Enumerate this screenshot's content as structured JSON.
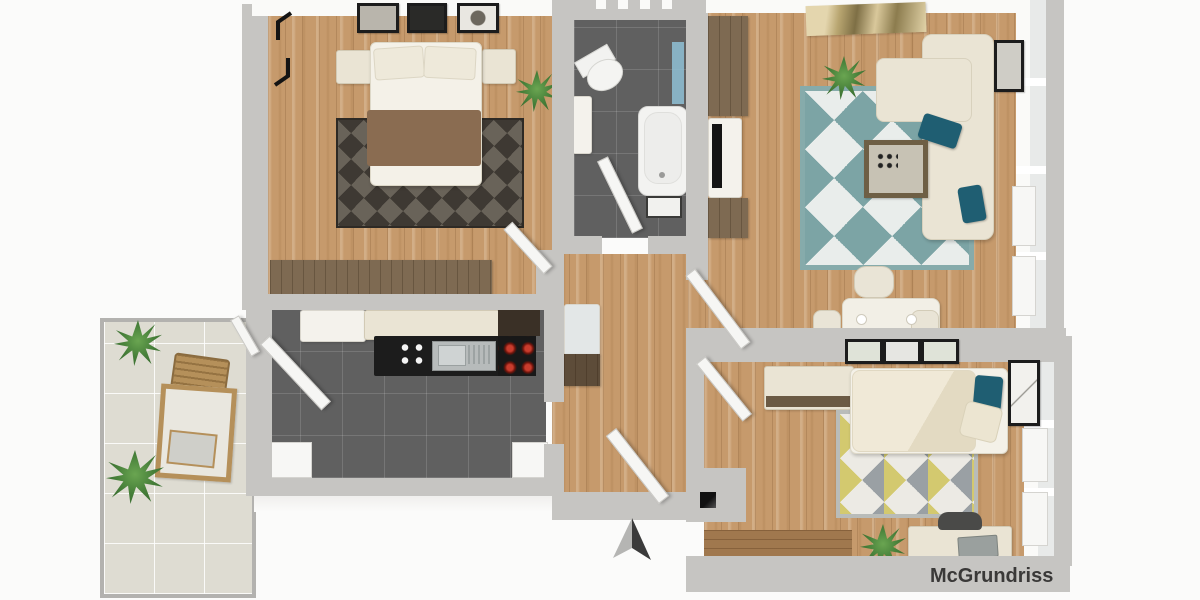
{
  "watermark": {
    "label": "McGrundriss"
  },
  "icons": {
    "north_arrow": "two-tone up triangle ▲",
    "rotation_marker": "black rotation arrows glyph",
    "entry_door_marker": "black square"
  },
  "colors": {
    "background": "#fbfbfa",
    "wall": "#c6c5c2",
    "wall_face": "#fafaf8",
    "wood": "#c69a6c",
    "wood_dark": "#a0784e",
    "tile_dark": "#606060",
    "tile_light": "#dedcd2",
    "rug_teal": "#7ca4a5",
    "rug_gray": "#9aa0a4",
    "rug_yellow": "#d3c96f",
    "teal_pillow": "#1f5e72",
    "cream_furniture": "#eae4d4",
    "brown_furniture": "#7e6a52",
    "blanket_brown": "#8a6c51",
    "counter_black": "#1c1c1c",
    "cooktop_red": "#c23b2e",
    "steel": "#b7bbbb",
    "plant": "#2f5e28",
    "glass": "#e8eae9",
    "north_light": "#b5b5b3",
    "north_dark": "#3b3b3b",
    "frame_black": "#1c1c1c",
    "watermark_text": "#3a3938"
  }
}
